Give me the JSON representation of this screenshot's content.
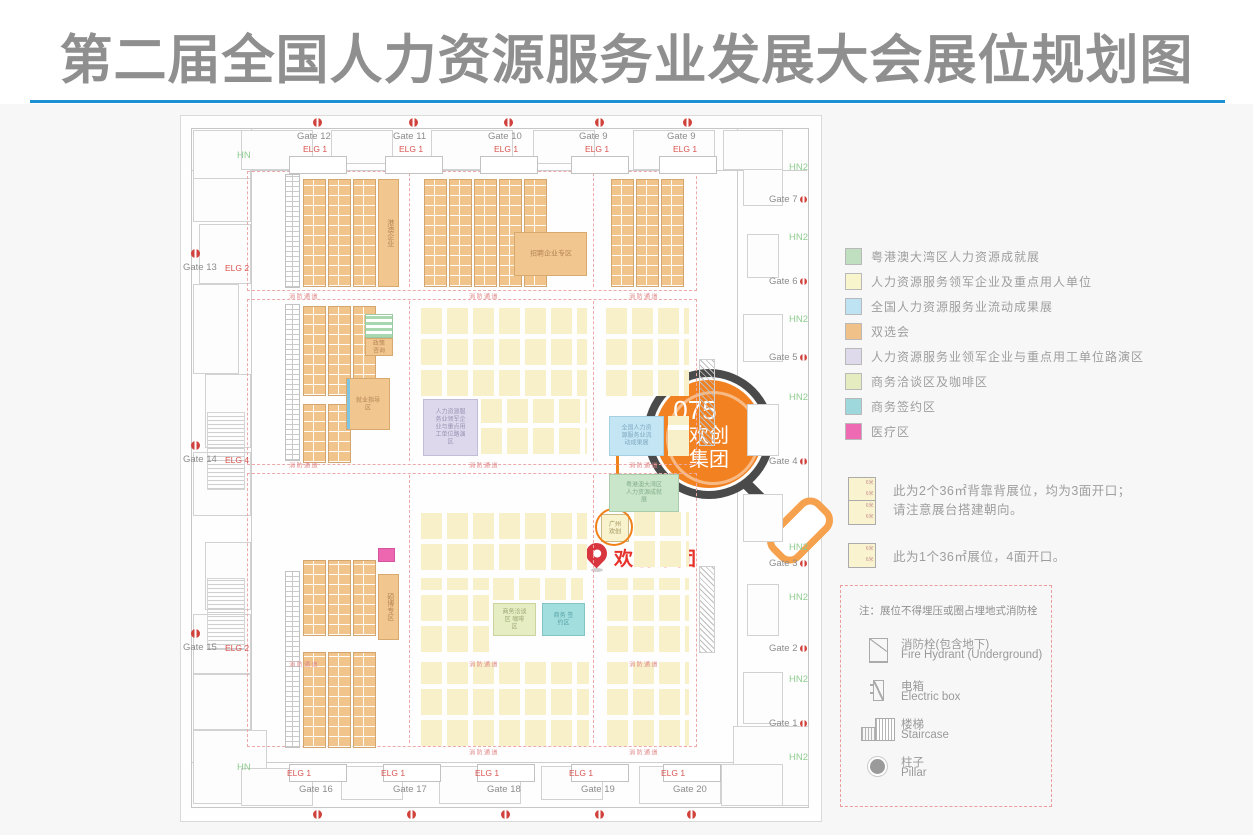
{
  "title": "第二届全国人力资源服务业发展大会展位规划图",
  "plan": {
    "aisle_label": "消防通道",
    "hn_label": "HN",
    "hn2_label": "HN2",
    "gates_top": [
      {
        "label": "Gate 12",
        "sub": "ELG 1"
      },
      {
        "label": "Gate 11",
        "sub": "ELG 1"
      },
      {
        "label": "Gate 10",
        "sub": "ELG 1"
      },
      {
        "label": "Gate 9",
        "sub": "ELG 1"
      },
      {
        "label": "Gate 9",
        "sub": "ELG 1"
      }
    ],
    "gates_bottom": [
      {
        "label": "Gate 16",
        "sub": "ELG 1"
      },
      {
        "label": "Gate 17",
        "sub": "ELG 1"
      },
      {
        "label": "Gate 18",
        "sub": "ELG 1"
      },
      {
        "label": "Gate 19",
        "sub": "ELG 1"
      },
      {
        "label": "Gate 20",
        "sub": "ELG 1"
      }
    ],
    "gates_left": [
      {
        "label": "Gate 13",
        "sub": "ELG 2"
      },
      {
        "label": "Gate 14",
        "sub": "ELG 4"
      },
      {
        "label": "Gate 15",
        "sub": "ELG 2"
      }
    ],
    "gates_right": [
      {
        "label": "Gate 7"
      },
      {
        "label": "Gate 6"
      },
      {
        "label": "Gate 5"
      },
      {
        "label": "Gate 4"
      },
      {
        "label": "Gate 3"
      },
      {
        "label": "Gate 2"
      },
      {
        "label": "Gate 1"
      }
    ],
    "zones": {
      "gangao": "港澳企业",
      "qiye_zone": "招聘企业专区",
      "zhengce": "政策咨询",
      "jiuye": "就业指导区",
      "luyan": "人力资源服务业领军企业与重点用工单位路演区",
      "liudong": "全国人力资源服务业流动成果展",
      "dawan": "粤港澳大湾区 人力资源成就展",
      "qiatan": "商务洽谈区 咖啡区",
      "qianyue": "商务 签约区",
      "shuobo": "硕博专区"
    },
    "highlight": {
      "booth_text": "广州欢创",
      "pin_label": "欢创集团",
      "mag_no": "075",
      "mag_line1": "欢创",
      "mag_line2": "集团"
    }
  },
  "legend": {
    "items": [
      {
        "color": "#BFDFC0",
        "label": "粤港澳大湾区人力资源成就展"
      },
      {
        "color": "#F8F5CC",
        "label": "人力资源服务领军企业及重点用人单位"
      },
      {
        "color": "#BEE3F2",
        "label": "全国人力资源服务业流动成果展"
      },
      {
        "color": "#F0C289",
        "label": "双选会"
      },
      {
        "color": "#DEDAEC",
        "label": "人力资源服务业领军企业与重点用工单位路演区"
      },
      {
        "color": "#E4ECC0",
        "label": "商务洽谈区及咖啡区"
      },
      {
        "color": "#9FD8DC",
        "label": "商务签约区"
      },
      {
        "color": "#EE6BB4",
        "label": "医疗区"
      }
    ]
  },
  "notes": [
    {
      "squares": 2,
      "dim": "6米",
      "lines": [
        "此为2个36㎡背靠背展位，均为3面开口；",
        "请注意展台搭建朝向。"
      ]
    },
    {
      "squares": 1,
      "dim": "6米",
      "lines": [
        "此为1个36㎡展位，4面开口。"
      ]
    }
  ],
  "symbol_box": {
    "note": "注：展位不得埋压或圈占埋地式消防栓",
    "items": [
      {
        "icon": "fire-hydrant",
        "zh": "消防栓(包含地下)",
        "en": "Fire Hydrant (Underground)"
      },
      {
        "icon": "electric-box",
        "zh": "电箱",
        "en": "Electric box"
      },
      {
        "icon": "staircase",
        "zh": "楼梯",
        "en": "Staircase"
      },
      {
        "icon": "pillar",
        "zh": "柱子",
        "en": "Pillar"
      }
    ]
  }
}
